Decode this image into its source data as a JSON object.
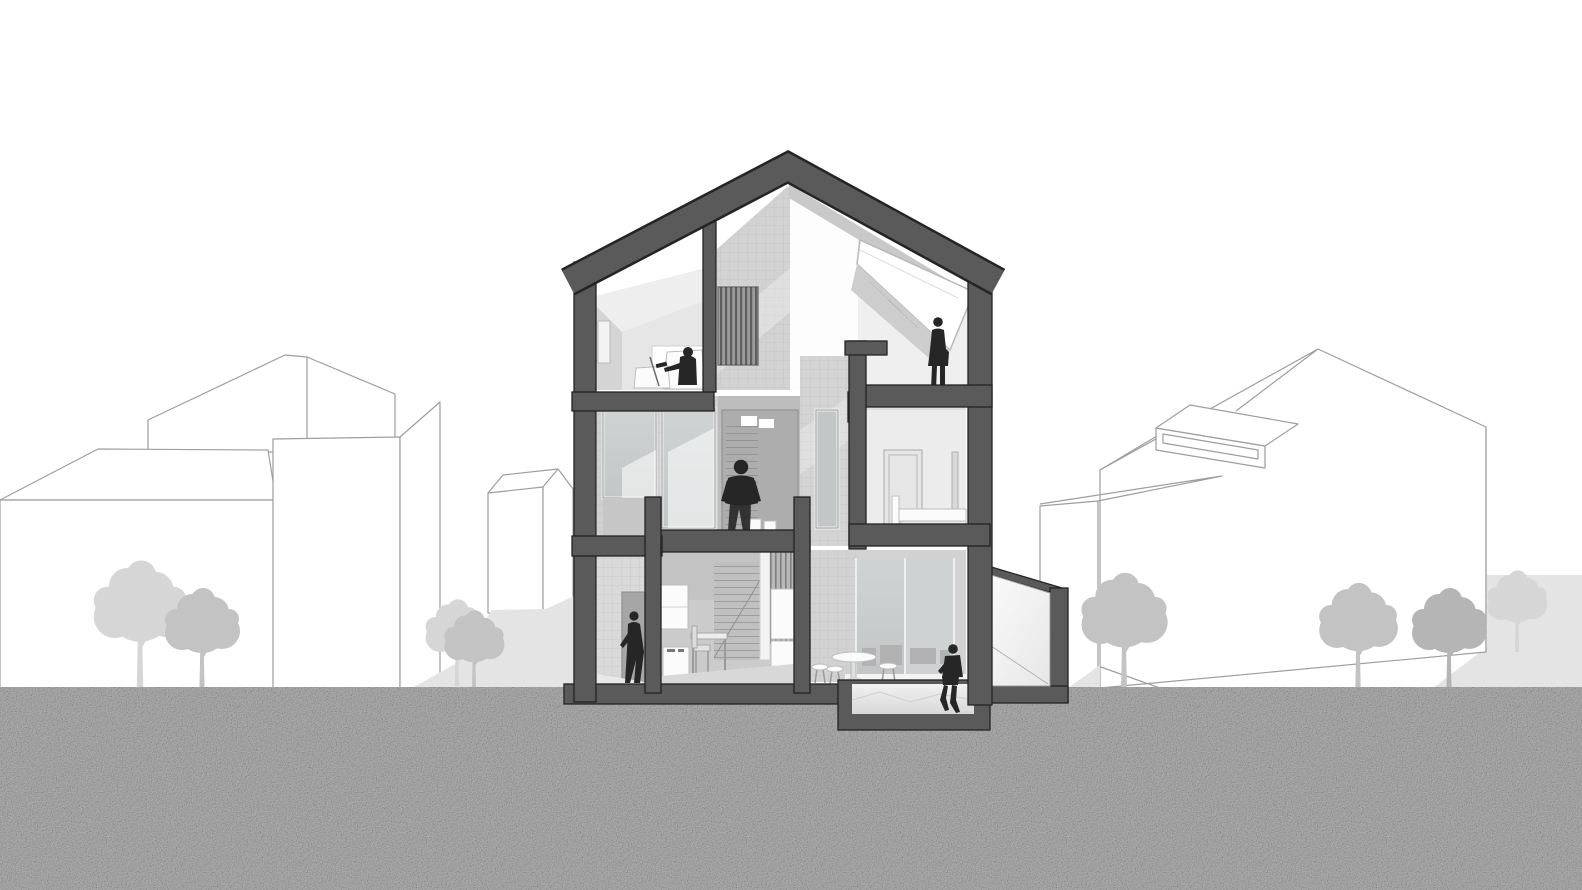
{
  "title": "Architectural cross-section perspective of a three-storey gabled townhouse between neighbouring buildings",
  "palette": {
    "background": "#ffffff",
    "ground": "#a9a9a9",
    "plane_light": "#e4e4e4",
    "neighbor_line": "#9e9e9e",
    "neighbor_fill": "#ffffff",
    "poche": "#5a5a5a",
    "poche_outline": "#242424",
    "interior_light": "#efefef",
    "interior_mid": "#d2d2d2",
    "interior_dark": "#bdbdbd",
    "glass": "#c9cdce",
    "figure": "#262626",
    "white_furniture": "#fbfbfb",
    "tree_light": "#d6d6d6",
    "tree_mid": "#c3c3c3",
    "tree_dark": "#b5b5b5"
  },
  "scene": {
    "type": "section-perspective-rendering",
    "cut_material": "dark-grey poche with black outline",
    "ground": "speckled concrete-grey earth band below street level",
    "floors": [
      {
        "name": "attic",
        "rooms": [
          "study with sloped ceiling, seated reader, armchairs, picture window",
          "open void over stair with louvred screen",
          "gallery with long sloped rooflight and standing woman"
        ]
      },
      {
        "name": "first",
        "rooms": [
          "glazed window bay (two tall panes)",
          "stair hall with glazed door and standing man",
          "slot-window wall",
          "bedroom with door, mirror and bed"
        ]
      },
      {
        "name": "ground",
        "rooms": [
          "entry hall with walking woman and rear door",
          "kitchen-study with wall cabinets, desk, chair and staircase",
          "dining room with pedestal table, stools and glazed rear wall",
          "sunken court with seated woman and low garden wall"
        ]
      }
    ],
    "figures": [
      {
        "id": "seated-reader",
        "location": "attic study"
      },
      {
        "id": "standing-woman",
        "location": "attic gallery at rooflight"
      },
      {
        "id": "standing-man",
        "location": "first-floor stair hall"
      },
      {
        "id": "walking-woman",
        "location": "ground-floor entry hall"
      },
      {
        "id": "seated-woman",
        "location": "edge of sunken court"
      }
    ],
    "neighbors": {
      "left": [
        "low hipped-roof block",
        "gabled block behind",
        "tall flat-roof tower",
        "small gabled house"
      ],
      "right": [
        "shed-roof wing",
        "large gabled house with long roof dormer",
        "backdrop plane far right"
      ]
    },
    "trees": {
      "count": 9,
      "style": "flat grey silhouettes, light behind, darker in front"
    }
  }
}
